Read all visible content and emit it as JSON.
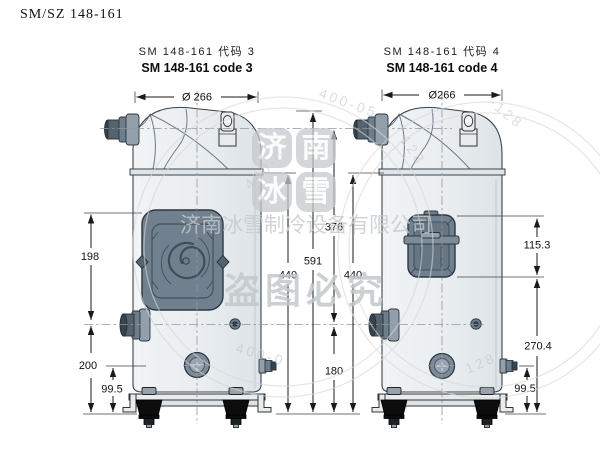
{
  "header": {
    "doc_code": "SM/SZ 148-161"
  },
  "views": {
    "left": {
      "title_cn": "SM 148-161 代码 3",
      "title_en": "SM 148-161 code 3",
      "dims": {
        "diameter": "Ø 266",
        "upper": "198",
        "lower": "200",
        "sight": "99.5",
        "body": "440",
        "total": "591"
      }
    },
    "right": {
      "title_cn": "SM 148-161 代码 4",
      "title_en": "SM 148-161 code 4",
      "dims": {
        "diameter": "Ø266",
        "discharge_to_suction": "376",
        "suction_to_base": "180",
        "body": "440",
        "box_height": "115.3",
        "box_to_base": "270.4",
        "port_to_base": "99.5"
      }
    }
  },
  "watermark": {
    "logo_chars": [
      "济",
      "南",
      "冰",
      "雪"
    ],
    "company": "济南冰雪制冷设备有限公司",
    "warning": "盗图必究",
    "arcs": [
      "400-0",
      "400-05",
      "128",
      "-128",
      "400-0",
      "128"
    ]
  }
}
